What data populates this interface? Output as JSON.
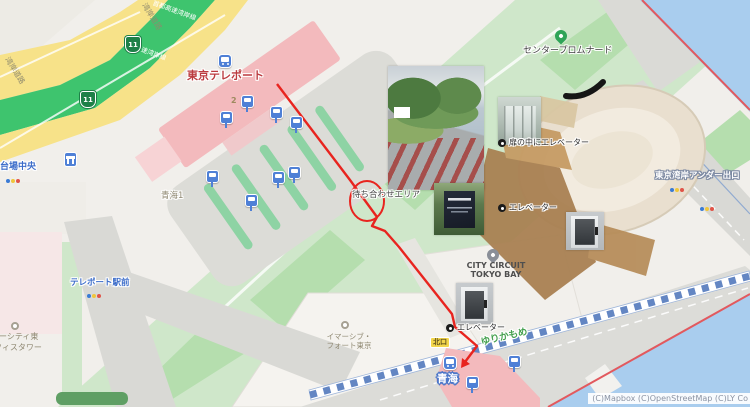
{
  "map": {
    "attribution": "(C)Mapbox (C)OpenStreetMap (C)LY Co",
    "roads": {
      "wangan_road": "湾岸道路",
      "shuto_expressway_wangan_line": "首都高速湾岸線",
      "route_shield": "11",
      "tokyo_wangan_under_exit": "東京湾岸アンダー出口"
    },
    "stations": {
      "tokyo_teleport": "東京テレポート",
      "aomi": "青海",
      "yurikamome_line": "ゆりかもめ",
      "exit_number": "2",
      "north_exit": "北口"
    },
    "places": {
      "center_promenade": "センタープロムナード",
      "aomi_1_chome": "青海1",
      "daiba_chuo": "台場中央",
      "teleport_ekimae": "テレポート駅前",
      "city_circuit_line1": "CITY CIRCUIT",
      "city_circuit_line2": "TOKYO BAY",
      "immersive_fort_line1": "イマーシブ・",
      "immersive_fort_line2": "フォート東京",
      "divercity_tower_line1": "バーシティ東",
      "divercity_tower_line2": "フィスタワー"
    },
    "annotations": {
      "meeting_area": "待ち合わせエリア",
      "elevator_behind_door": "扉の中にエレベーター",
      "elevator": "エレベーター"
    },
    "icons": {
      "train_station": "train-icon",
      "bus_stop": "bus-stop-icon",
      "poi_pin": "map-pin-icon",
      "traffic_light": "traffic-light-dots",
      "footbridge": "footbridge-icon",
      "point_marker": "dot-marker-icon"
    },
    "colors": {
      "route_red": "#e8241f",
      "water_blue": "#a9cdee",
      "expressway_green": "#3ec46e",
      "road_yellow": "#f7e289",
      "park_green": "#cfe7ca",
      "station_pink": "#f3babd",
      "label_blue": "#3b6cc9",
      "station_label_red": "#bb3b3f"
    }
  }
}
